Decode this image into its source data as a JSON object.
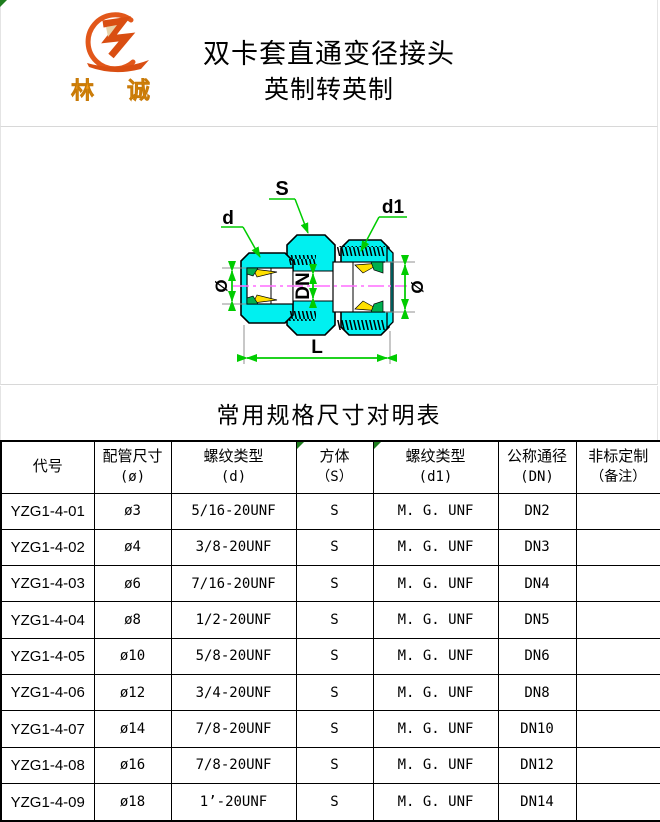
{
  "header": {
    "logo": {
      "char_left": "林",
      "char_right": "诚",
      "brand_color": "#e2571a",
      "text_color": "#f59a10"
    },
    "title_line1": "双卡套直通变径接头",
    "title_line2": "英制转英制"
  },
  "drawing": {
    "labels": {
      "d": "d",
      "s": "S",
      "d1": "d1",
      "dia_left": "Ø",
      "dia_right": "Ø",
      "dn": "DN",
      "l": "L"
    },
    "colors": {
      "body_fill": "#00f0f0",
      "dimension_green": "#00cc00",
      "centerline_magenta": "#ff6dff",
      "ferrule_yellow": "#ffe000",
      "ferrule_green": "#00b050",
      "extension_gray": "#909090"
    }
  },
  "table": {
    "title": "常用规格尺寸对明表",
    "headers": [
      {
        "line1": "代号",
        "line2": ""
      },
      {
        "line1": "配管尺寸",
        "line2": "(ø)"
      },
      {
        "line1": "螺纹类型",
        "line2": "(d)"
      },
      {
        "line1": "方体",
        "line2": "（S）"
      },
      {
        "line1": "螺纹类型",
        "line2": "(d1)"
      },
      {
        "line1": "公称通径",
        "line2": "(DN)"
      },
      {
        "line1": "非标定制",
        "line2": "（备注）"
      }
    ],
    "rows": [
      {
        "code": "YZG1-4-01",
        "pipe_size": "ø3",
        "thread_d": "5/16-20UNF",
        "body": "S",
        "thread_d1": "M. G. UNF",
        "dn": "DN2",
        "note": ""
      },
      {
        "code": "YZG1-4-02",
        "pipe_size": "ø4",
        "thread_d": "3/8-20UNF",
        "body": "S",
        "thread_d1": "M. G. UNF",
        "dn": "DN3",
        "note": ""
      },
      {
        "code": "YZG1-4-03",
        "pipe_size": "ø6",
        "thread_d": "7/16-20UNF",
        "body": "S",
        "thread_d1": "M. G. UNF",
        "dn": "DN4",
        "note": ""
      },
      {
        "code": "YZG1-4-04",
        "pipe_size": "ø8",
        "thread_d": "1/2-20UNF",
        "body": "S",
        "thread_d1": "M. G. UNF",
        "dn": "DN5",
        "note": ""
      },
      {
        "code": "YZG1-4-05",
        "pipe_size": "ø10",
        "thread_d": "5/8-20UNF",
        "body": "S",
        "thread_d1": "M. G. UNF",
        "dn": "DN6",
        "note": ""
      },
      {
        "code": "YZG1-4-06",
        "pipe_size": "ø12",
        "thread_d": "3/4-20UNF",
        "body": "S",
        "thread_d1": "M. G. UNF",
        "dn": "DN8",
        "note": ""
      },
      {
        "code": "YZG1-4-07",
        "pipe_size": "ø14",
        "thread_d": "7/8-20UNF",
        "body": "S",
        "thread_d1": "M. G. UNF",
        "dn": "DN10",
        "note": ""
      },
      {
        "code": "YZG1-4-08",
        "pipe_size": "ø16",
        "thread_d": "7/8-20UNF",
        "body": "S",
        "thread_d1": "M. G. UNF",
        "dn": "DN12",
        "note": ""
      },
      {
        "code": "YZG1-4-09",
        "pipe_size": "ø18",
        "thread_d": "1’-20UNF",
        "body": "S",
        "thread_d1": "M. G. UNF",
        "dn": "DN14",
        "note": ""
      }
    ]
  }
}
